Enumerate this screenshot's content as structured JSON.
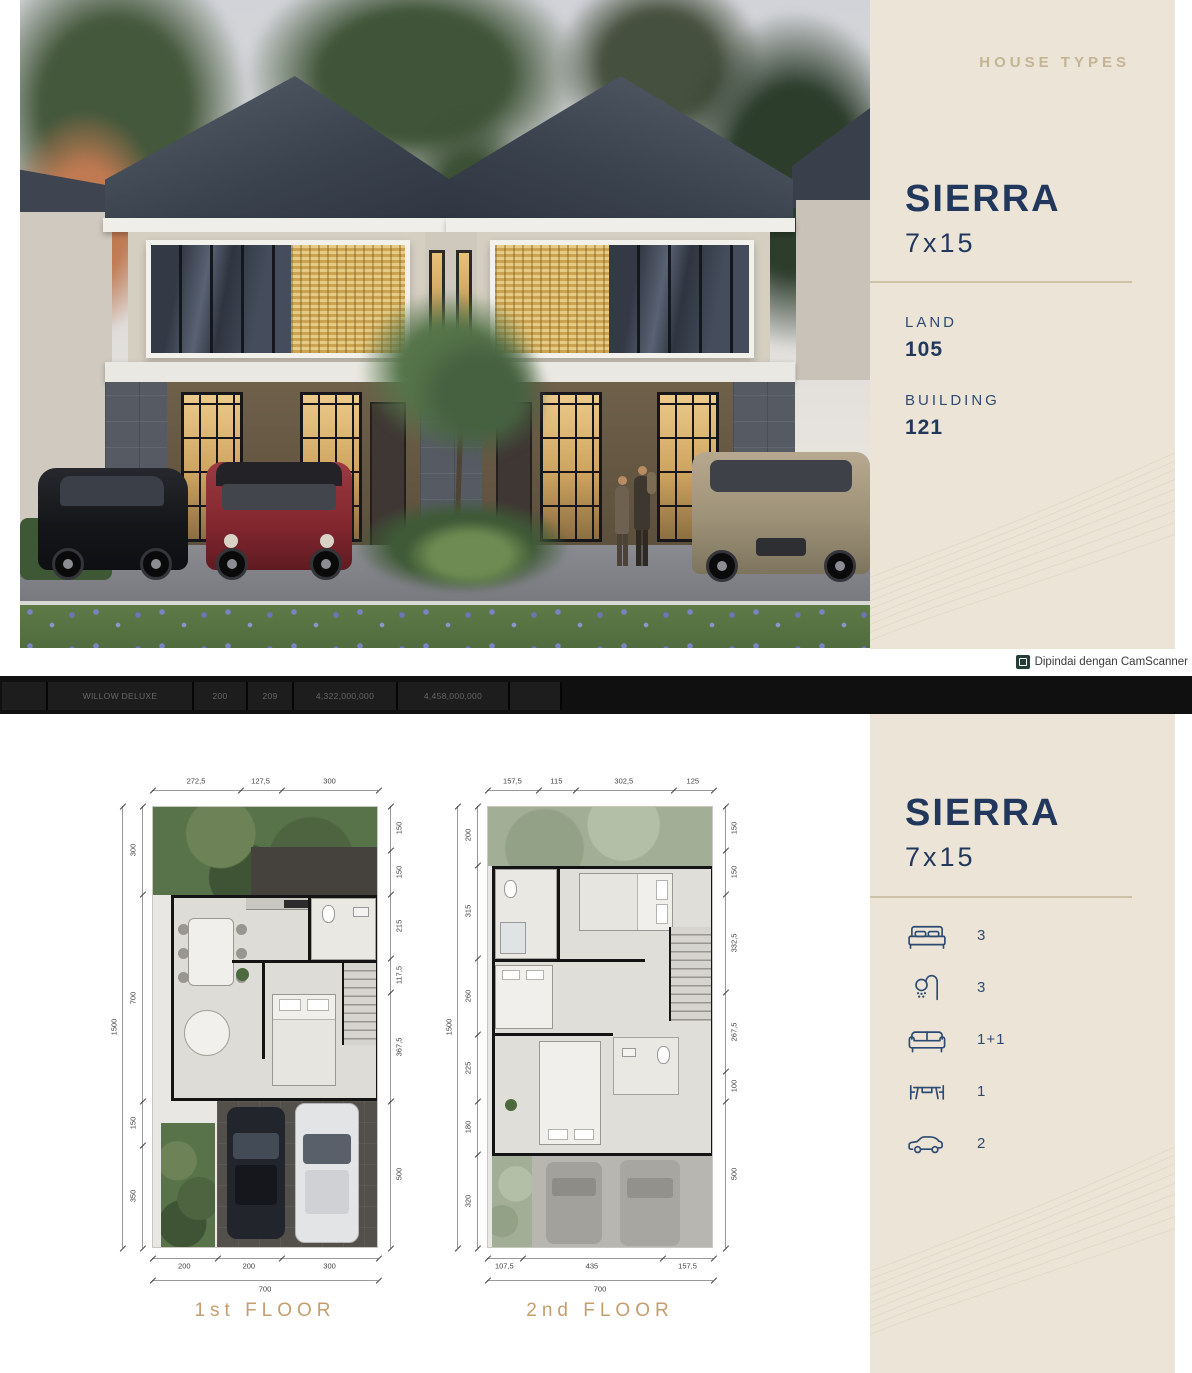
{
  "panel_top": {
    "heading": "HOUSE TYPES",
    "name": "SIERRA",
    "size": "7x15",
    "land_label": "LAND",
    "land_value": "105",
    "building_label": "BUILDING",
    "building_value": "121"
  },
  "scanner": {
    "note": "Dipindai dengan CamScanner"
  },
  "price_table": {
    "row": {
      "name": "WILLOW DELUXE",
      "land": "200",
      "building": "209",
      "price1": "4,322,000,000",
      "price2": "4,458,000,000"
    }
  },
  "panel_bottom": {
    "name": "SIERRA",
    "size": "7x15",
    "specs": [
      {
        "icon": "bed-icon",
        "value": "3"
      },
      {
        "icon": "shower-icon",
        "value": "3"
      },
      {
        "icon": "sofa-icon",
        "value": "1+1"
      },
      {
        "icon": "dining-table-icon",
        "value": "1"
      },
      {
        "icon": "car-icon",
        "value": "2"
      }
    ]
  },
  "floorplans": [
    {
      "label": "1st FLOOR",
      "dims": {
        "top": [
          "272,5",
          "127,5",
          "300"
        ],
        "right": [
          "150",
          "150",
          "215",
          "117,5",
          "367,5",
          "500"
        ],
        "bottom": [
          "200",
          "200",
          "300"
        ],
        "bottom_total": "700",
        "left": [
          "300",
          "700",
          "150",
          "350"
        ],
        "left_total": "1500"
      }
    },
    {
      "label": "2nd FLOOR",
      "dims": {
        "top": [
          "157,5",
          "115",
          "302,5",
          "125"
        ],
        "right": [
          "150",
          "150",
          "332,5",
          "267,5",
          "100",
          "500"
        ],
        "bottom": [
          "107,5",
          "435",
          "157,5"
        ],
        "bottom_total": "700",
        "left": [
          "200",
          "315",
          "260",
          "225",
          "180",
          "320"
        ],
        "left_total": "1500"
      }
    }
  ],
  "colors": {
    "navy": "#21375c",
    "cream": "#ece5d7",
    "tan_heading": "#c3b494",
    "floor_label_tan": "#c49e6e",
    "gold_divider": "#cdc2a6"
  }
}
